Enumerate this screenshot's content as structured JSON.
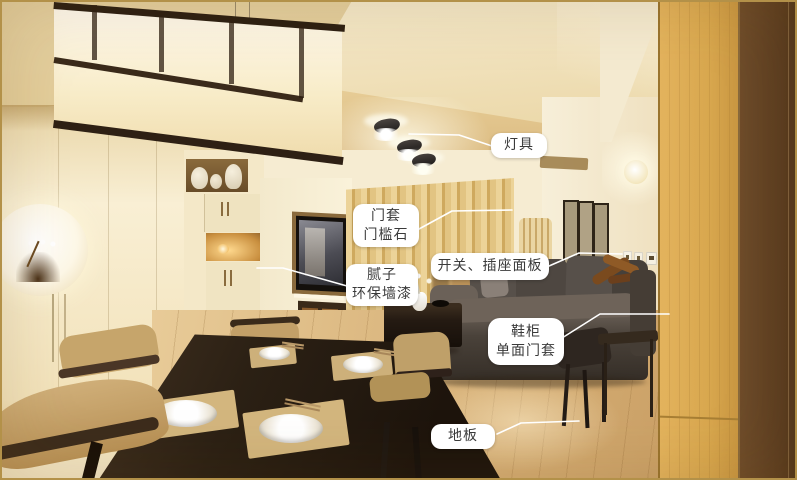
{
  "annotations": [
    {
      "id": "lighting",
      "lines": [
        "灯具"
      ]
    },
    {
      "id": "door-frame-threshold",
      "lines": [
        "门套",
        "门槛石"
      ]
    },
    {
      "id": "switch-socket-panel",
      "lines": [
        "开关、插座面板"
      ]
    },
    {
      "id": "putty-eco-wall-paint",
      "lines": [
        "腻子",
        "环保墙漆"
      ]
    },
    {
      "id": "shoe-cabinet-door-frame",
      "lines": [
        "鞋柜",
        "单面门套"
      ]
    },
    {
      "id": "wood-floor",
      "lines": [
        "地板"
      ]
    }
  ],
  "colors": {
    "label_background": "#ffffff",
    "label_text": "#3a3a3a",
    "leader_line": "#ffffff",
    "photo_border": "#b39149"
  }
}
